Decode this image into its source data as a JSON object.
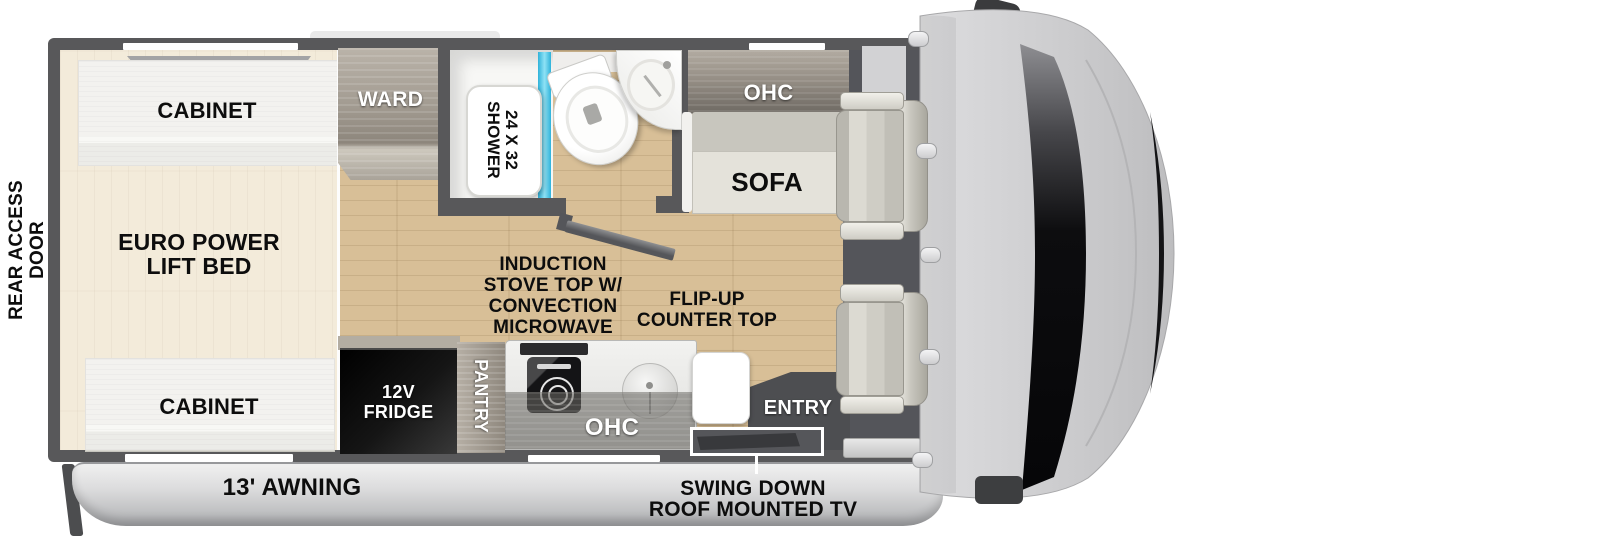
{
  "exterior": {
    "rear_access_door": {
      "line1": "REAR ACCESS",
      "line2": "DOOR"
    },
    "awning_label": "13' AWNING",
    "tv_note": {
      "line1": "SWING DOWN",
      "line2": "ROOF MOUNTED TV"
    }
  },
  "bedroom": {
    "cabinet_top": "CABINET",
    "cabinet_bottom": "CABINET",
    "bed": {
      "line1": "EURO POWER",
      "line2": "LIFT BED"
    }
  },
  "wardrobe": {
    "label": "WARD"
  },
  "bathroom": {
    "shower": {
      "line1": "24 X 32",
      "line2": "SHOWER"
    }
  },
  "living": {
    "overhead_cabinet": "OHC",
    "sofa": "SOFA"
  },
  "kitchen": {
    "fridge": {
      "line1": "12V",
      "line2": "FRIDGE"
    },
    "pantry": "PANTRY",
    "overhead_cabinet": "OHC",
    "stove_note": {
      "line1": "INDUCTION",
      "line2": "STOVE TOP W/",
      "line3": "CONVECTION",
      "line4": "MICROWAVE"
    },
    "counter_note": {
      "line1": "FLIP-UP",
      "line2": "COUNTER TOP"
    }
  },
  "entry": {
    "label": "ENTRY"
  },
  "colors": {
    "wall": "#58585a",
    "floor_wood": "#d8bf97",
    "shower_glass": "#2fb2da",
    "fridge": "#111111",
    "awning": "#d9dadb",
    "cab_body": "#cccccd",
    "label_black": "#0d0d0d",
    "label_white": "#ffffff"
  }
}
